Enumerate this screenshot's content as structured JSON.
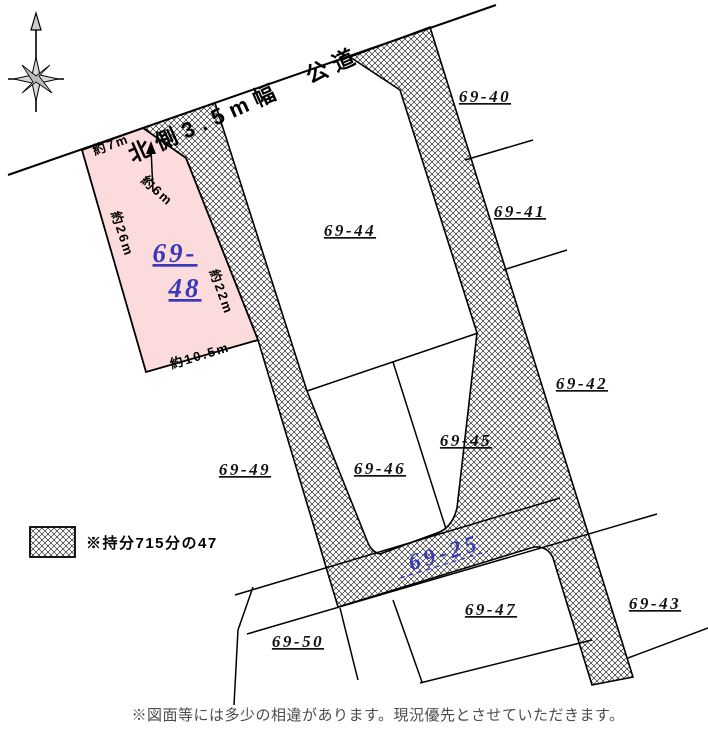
{
  "map": {
    "road_label": "北側3.5m幅　公道",
    "compass": {
      "direction": "north"
    },
    "highlight_parcel": {
      "id": "69-48",
      "label_line1": "69-",
      "label_line2": "48",
      "fill_color": "#FBDBDB",
      "label_color": "#3A3AB8",
      "dimensions": {
        "top": "約7m",
        "chamfer": "約6m",
        "left": "約26m",
        "right": "約22m",
        "bottom": "約10.5m"
      }
    },
    "shared_road": {
      "id": "69-25",
      "label": "69-25",
      "label_color": "#3A3AB8",
      "pattern": "crosshatch"
    },
    "parcels": [
      {
        "id": "69-40",
        "label": "69-40"
      },
      {
        "id": "69-41",
        "label": "69-41"
      },
      {
        "id": "69-42",
        "label": "69-42"
      },
      {
        "id": "69-43",
        "label": "69-43"
      },
      {
        "id": "69-44",
        "label": "69-44"
      },
      {
        "id": "69-45",
        "label": "69-45"
      },
      {
        "id": "69-46",
        "label": "69-46"
      },
      {
        "id": "69-47",
        "label": "69-47"
      },
      {
        "id": "69-49",
        "label": "69-49"
      },
      {
        "id": "69-50",
        "label": "69-50"
      }
    ],
    "legend": {
      "swatch": "crosshatch",
      "label": "※持分715分の47"
    },
    "footer_note": "※図面等には多少の相違があります。現況優先とさせていただきます。"
  }
}
